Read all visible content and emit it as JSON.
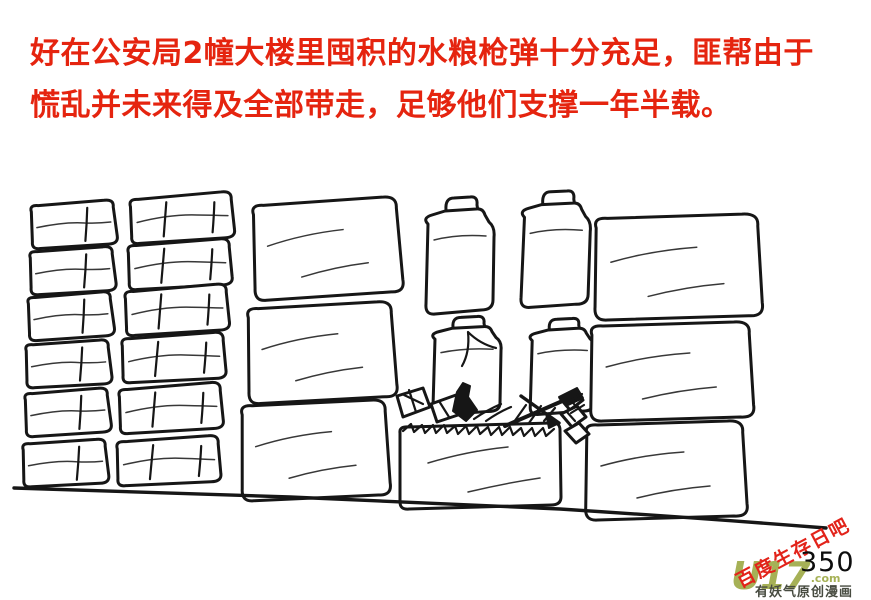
{
  "narration": {
    "line1": "好在公安局2幢大楼里囤积的水粮枪弹十分充足，匪帮由于",
    "line2": "慌乱并未来得及全部带走，足够他们支撑一年半载。",
    "color": "#e5240f"
  },
  "sketch": {
    "ink_color": "#161616"
  },
  "footer": {
    "page_number": "350",
    "watermark_diagonal": {
      "text": "百度生存日吧",
      "color": "#e2231a"
    },
    "logo": {
      "text": "U17",
      "suffix": ".com",
      "color": "#a6b156"
    },
    "logo_caption": {
      "text": "有妖气原创漫画",
      "color": "#474b40"
    }
  }
}
